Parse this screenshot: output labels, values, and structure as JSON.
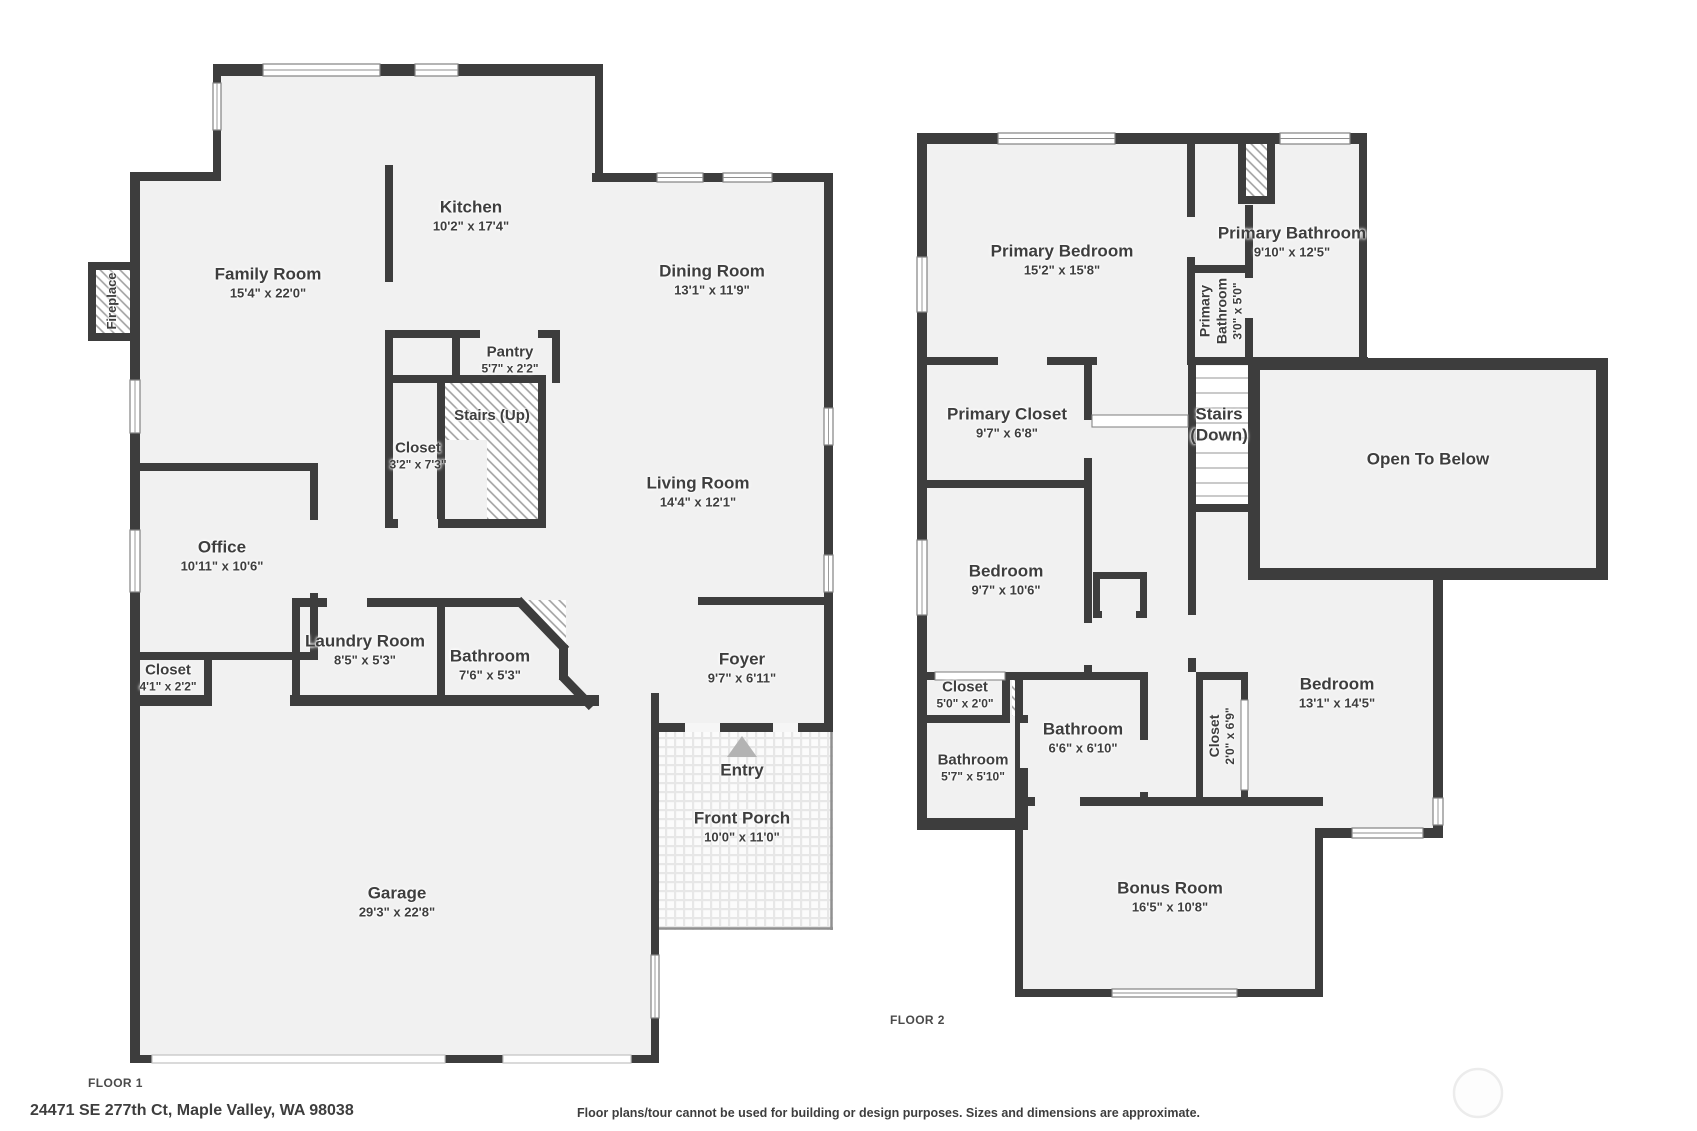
{
  "floor1": {
    "label": "FLOOR 1",
    "rooms": {
      "family_room": {
        "name": "Family Room",
        "dims": "15'4\" x 22'0\""
      },
      "kitchen": {
        "name": "Kitchen",
        "dims": "10'2\" x 17'4\""
      },
      "dining_room": {
        "name": "Dining Room",
        "dims": "13'1\" x 11'9\""
      },
      "pantry": {
        "name": "Pantry",
        "dims": "5'7\" x 2'2\""
      },
      "stairs_up": {
        "name": "Stairs (Up)"
      },
      "closet_stairs": {
        "name": "Closet",
        "dims": "3'2\" x 7'3\""
      },
      "living_room": {
        "name": "Living Room",
        "dims": "14'4\" x 12'1\""
      },
      "office": {
        "name": "Office",
        "dims": "10'11\" x 10'6\""
      },
      "closet_hall": {
        "name": "Closet",
        "dims": "4'1\" x 2'2\""
      },
      "laundry_room": {
        "name": "Laundry Room",
        "dims": "8'5\" x 5'3\""
      },
      "bathroom": {
        "name": "Bathroom",
        "dims": "7'6\" x 5'3\""
      },
      "foyer": {
        "name": "Foyer",
        "dims": "9'7\" x 6'11\""
      },
      "entry": {
        "name": "Entry"
      },
      "front_porch": {
        "name": "Front Porch",
        "dims": "10'0\" x 11'0\""
      },
      "garage": {
        "name": "Garage",
        "dims": "29'3\" x 22'8\""
      },
      "fireplace": {
        "name": "Fireplace"
      }
    }
  },
  "floor2": {
    "label": "FLOOR 2",
    "rooms": {
      "primary_bedroom": {
        "name": "Primary Bedroom",
        "dims": "15'2\" x 15'8\""
      },
      "primary_bathroom": {
        "name": "Primary Bathroom",
        "dims": "9'10\" x 12'5\""
      },
      "primary_bathroom_small": {
        "name": "Primary Bathroom",
        "dims": "3'0\" x 5'0\""
      },
      "primary_closet": {
        "name": "Primary Closet",
        "dims": "9'7\" x 6'8\""
      },
      "stairs_down": {
        "name": "Stairs (Down)"
      },
      "open_to_below": {
        "name": "Open To Below"
      },
      "bedroom_left": {
        "name": "Bedroom",
        "dims": "9'7\" x 10'6\""
      },
      "closet_small": {
        "name": "Closet",
        "dims": "5'0\" x 2'0\""
      },
      "bathroom_left": {
        "name": "Bathroom",
        "dims": "5'7\" x 5'10\""
      },
      "bathroom_mid": {
        "name": "Bathroom",
        "dims": "6'6\" x 6'10\""
      },
      "closet_tall": {
        "name": "Closet",
        "dims": "2'0\" x 6'9\""
      },
      "bedroom_right": {
        "name": "Bedroom",
        "dims": "13'1\" x 14'5\""
      },
      "bonus_room": {
        "name": "Bonus Room",
        "dims": "16'5\" x 10'8\""
      }
    }
  },
  "footer": {
    "address": "24471 SE 277th Ct, Maple Valley, WA 98038",
    "disclaimer": "Floor plans/tour cannot be used for building or design purposes. Sizes and dimensions are approximate."
  },
  "colors": {
    "wall": "#3d3d3d",
    "room_fill": "#f1f1f1",
    "hatch_line": "#9f9f9f",
    "label_text": "#3e3e3e",
    "entry_arrow": "#b3b3b3"
  }
}
